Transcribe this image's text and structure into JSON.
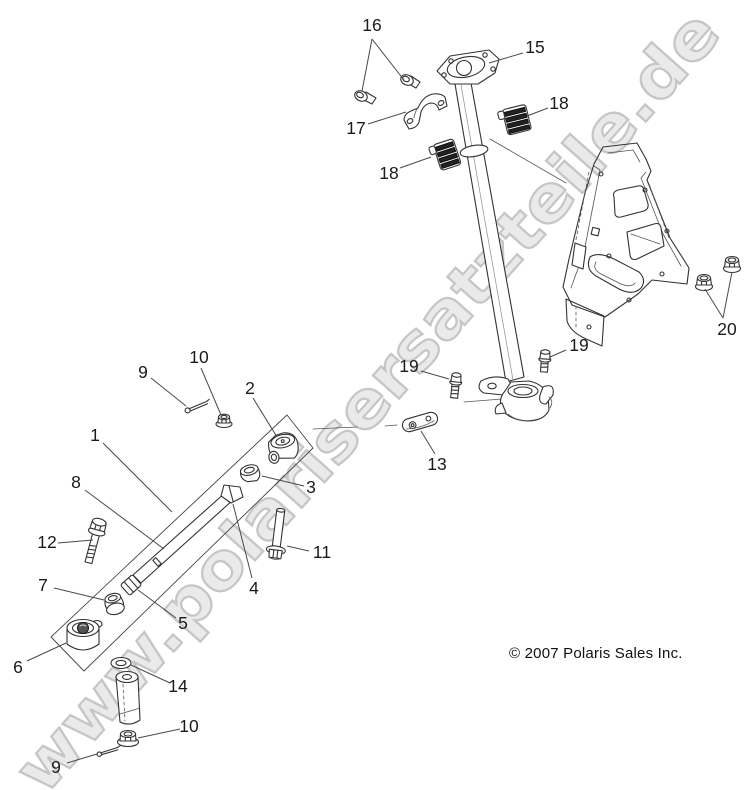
{
  "watermark": {
    "text": "www.polarisersatzteile.de",
    "fill": "#eaeaea",
    "outline": "#c6c6c6"
  },
  "footer": {
    "copyright": "© 2007 Polaris Sales Inc."
  },
  "diagram": {
    "description": "Exploded parts diagram of a steering assembly",
    "line_color": "#333333",
    "leader_color": "#4a4a4a",
    "label_color": "#1a1a1a",
    "callouts": [
      {
        "label": "16",
        "part": "flange-bolt",
        "x": 372,
        "y": 25,
        "leaders": [
          [
            372,
            39,
            362,
            91
          ],
          [
            372,
            39,
            404,
            80
          ]
        ]
      },
      {
        "label": "15",
        "part": "steering-post",
        "x": 535,
        "y": 47,
        "leaders": [
          [
            523,
            53,
            489,
            63
          ]
        ]
      },
      {
        "label": "17",
        "part": "post-clamp",
        "x": 356,
        "y": 128,
        "leaders": [
          [
            368,
            124,
            406,
            112
          ]
        ]
      },
      {
        "label": "18",
        "part": "post-bushing",
        "x": 559,
        "y": 103,
        "leaders": [
          [
            548,
            108,
            527,
            116
          ]
        ]
      },
      {
        "label": "18",
        "part": "post-bushing",
        "x": 389,
        "y": 173,
        "leaders": [
          [
            400,
            168,
            431,
            157
          ]
        ]
      },
      {
        "label": "20",
        "part": "flange-nut",
        "x": 727,
        "y": 329,
        "leaders": [
          [
            723,
            318,
            732,
            272
          ],
          [
            723,
            318,
            705,
            289
          ]
        ]
      },
      {
        "label": "19",
        "part": "pinch-bolt",
        "x": 409,
        "y": 366,
        "leaders": [
          [
            421,
            371,
            449,
            379
          ]
        ]
      },
      {
        "label": "19",
        "part": "pinch-bolt",
        "x": 579,
        "y": 345,
        "leaders": [
          [
            566,
            350,
            550,
            357
          ]
        ]
      },
      {
        "label": "13",
        "part": "link-plate",
        "x": 437,
        "y": 464,
        "leaders": [
          [
            435,
            454,
            421,
            431
          ]
        ]
      },
      {
        "label": "2",
        "part": "ball-joint",
        "x": 250,
        "y": 388,
        "leaders": [
          [
            253,
            398,
            277,
            437
          ]
        ]
      },
      {
        "label": "10",
        "part": "flange-nut",
        "x": 199,
        "y": 357,
        "leaders": [
          [
            201,
            368,
            221,
            415
          ]
        ]
      },
      {
        "label": "9",
        "part": "cotter-pin",
        "x": 143,
        "y": 372,
        "leaders": [
          [
            151,
            378,
            186,
            406
          ]
        ]
      },
      {
        "label": "1",
        "part": "tie-rod-assembly",
        "x": 95,
        "y": 435,
        "leaders": [
          [
            103,
            443,
            172,
            512
          ]
        ]
      },
      {
        "label": "8",
        "part": "tie-rod-tube",
        "x": 76,
        "y": 482,
        "leaders": [
          [
            85,
            490,
            164,
            549
          ]
        ]
      },
      {
        "label": "12",
        "part": "hex-flange-bolt",
        "x": 47,
        "y": 542,
        "leaders": [
          [
            58,
            543,
            93,
            540
          ]
        ]
      },
      {
        "label": "3",
        "part": "rod-end",
        "x": 311,
        "y": 487,
        "leaders": [
          [
            304,
            486,
            262,
            476
          ]
        ]
      },
      {
        "label": "11",
        "part": "hex-bolt",
        "x": 322,
        "y": 552,
        "leaders": [
          [
            309,
            551,
            287,
            546
          ]
        ]
      },
      {
        "label": "4",
        "part": "inner-tie-rod",
        "x": 254,
        "y": 588,
        "leaders": [
          [
            252,
            578,
            233,
            504
          ]
        ]
      },
      {
        "label": "7",
        "part": "outer-rod-end",
        "x": 43,
        "y": 585,
        "leaders": [
          [
            54,
            588,
            104,
            600
          ]
        ]
      },
      {
        "label": "5",
        "part": "jam-nut",
        "x": 183,
        "y": 623,
        "leaders": [
          [
            176,
            618,
            138,
            590
          ]
        ]
      },
      {
        "label": "6",
        "part": "pivot-bushing",
        "x": 18,
        "y": 667,
        "leaders": [
          [
            27,
            661,
            66,
            643
          ]
        ]
      },
      {
        "label": "14",
        "part": "washer",
        "x": 178,
        "y": 686,
        "leaders": [
          [
            170,
            683,
            131,
            665
          ]
        ]
      },
      {
        "label": "10",
        "part": "flange-nut",
        "x": 189,
        "y": 726,
        "leaders": [
          [
            180,
            729,
            138,
            738
          ]
        ]
      },
      {
        "label": "9",
        "part": "cotter-pin",
        "x": 56,
        "y": 767,
        "leaders": [
          [
            67,
            763,
            97,
            754
          ]
        ]
      }
    ]
  }
}
